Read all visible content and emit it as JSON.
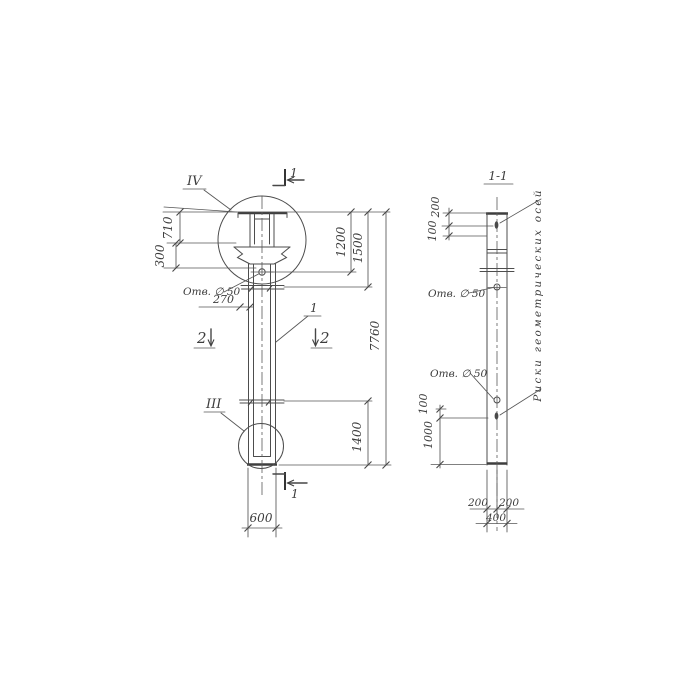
{
  "palette": {
    "paper": "#ffffff",
    "ink": "#474747"
  },
  "elevation": {
    "detail_top": "IV",
    "detail_bottom": "III",
    "cut1_top": "1",
    "cut1_bottom": "1",
    "cut2_left": "2",
    "cut2_right": "2",
    "pos_label": "1",
    "hole_label": "Отв. ∅ 50",
    "dim_710": "710",
    "dim_300": "300",
    "dim_270": "270",
    "dim_1200": "1200",
    "dim_1500": "1500",
    "dim_7760": "7760",
    "dim_1400": "1400",
    "dim_600": "600"
  },
  "section": {
    "title": "1-1",
    "dim_200_top": "200",
    "dim_100_top": "100",
    "hole_upper_label": "Отв. ∅ 50",
    "hole_lower_label": "Отв. ∅ 50",
    "dim_100_bottom": "100",
    "dim_1000": "1000",
    "dim_200_bottom_left": "200",
    "dim_200_bottom_right": "200",
    "dim_400": "400",
    "axes_note": "Риски геометрических осей"
  }
}
